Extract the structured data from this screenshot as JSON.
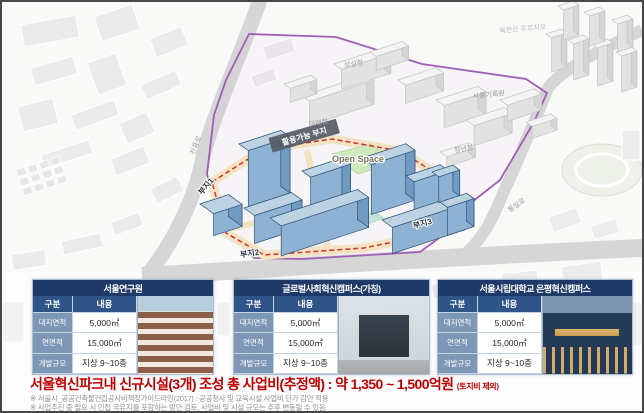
{
  "map": {
    "labels": {
      "road_jinheung": "진흥로",
      "road_tongil": "통일로",
      "apt_bukhansan": "북한산 푸르지오",
      "bldg_sangsang": "상상청",
      "bldg_mirae": "미래청",
      "bldg_cheongnyeon": "청년청",
      "bldg_archives": "서울기록원",
      "usable_site": "활용가능 부지",
      "open_space": "Open Space",
      "site1": "부지1",
      "site2": "부지2",
      "site3": "부지3"
    },
    "colors": {
      "site_boundary_red": "#cf3333",
      "park_boundary_purple": "#a05fb5",
      "new_building_blue": "#8db2d4",
      "open_space_green": "#cfe9bd",
      "perimeter_road_yellow": "#f3e3c3"
    }
  },
  "facilities": {
    "col_headers": {
      "type": "구분",
      "content": "내용"
    },
    "items": [
      {
        "title": "서울연구원",
        "rows": [
          {
            "label": "대지면적",
            "value": "5,000㎡"
          },
          {
            "label": "연면적",
            "value": "15,000㎡"
          },
          {
            "label": "개발규모",
            "value": "지상 9~10층"
          }
        ]
      },
      {
        "title": "글로벌사회혁신캠퍼스(가칭)",
        "rows": [
          {
            "label": "대지면적",
            "value": "5,000㎡"
          },
          {
            "label": "연면적",
            "value": "15,000㎡"
          },
          {
            "label": "개발규모",
            "value": "지상 9~10층"
          }
        ]
      },
      {
        "title": "서울시립대학교 은평혁신캠퍼스",
        "rows": [
          {
            "label": "대지면적",
            "value": "5,000㎡"
          },
          {
            "label": "연면적",
            "value": "15,000㎡"
          },
          {
            "label": "개발규모",
            "value": "지상 9~10층"
          }
        ]
      }
    ]
  },
  "summary": {
    "headline": "서울혁신파크내 신규시설(3개) 조성 총 사업비(추정액) : 약 1,350 ~ 1,500억원",
    "suffix": "(토지비 제외)",
    "footnotes": [
      "※ 서울시_공공건축물건립공사비책정가이드라인(2017) : 공공청사 및 교육시설 사업비 단가 감안 적용",
      "※ 사업추진 중 필요 시 인접 국유지를 포함하는 방안 검토, 사업비 및 시설 규모는 추후 변동될 수 있음."
    ]
  }
}
